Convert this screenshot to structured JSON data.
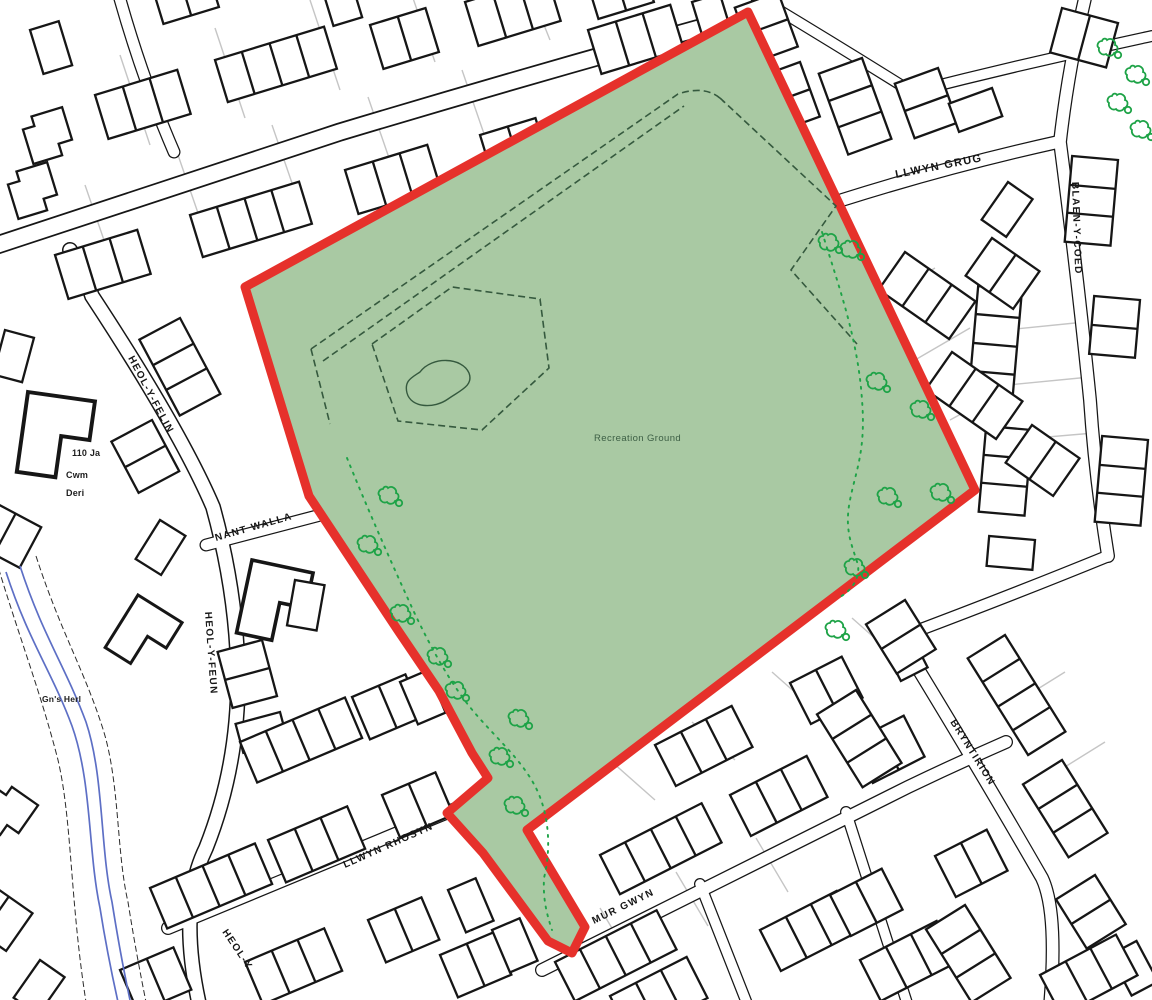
{
  "map": {
    "title": "Site location plan",
    "site_label": "Recreation Ground",
    "streets": {
      "llwyn_grug": "LLWYN GRUG",
      "blaen_y_coed": "BLAEN-Y-COED",
      "heol_y_felin": "HEOL-Y-FELIN",
      "nant_walla": "NANT WALLA",
      "heol_y_feun": "HEOL-Y-FEUN",
      "llwyn_rhosyn": "LLWYN RHOSYN",
      "mur_gwyn": "MUR GWYN",
      "bryntirion": "BRYNTIRION",
      "heol_y_partial": "HEOL-Y"
    },
    "places": {
      "cwm_deri_line1": "110 Ja",
      "cwm_deri_line2": "Cwm",
      "cwm_deri_line3": "Deri",
      "gns_herl": "Gn's Herl"
    }
  },
  "colors": {
    "boundary-red": "#e6312b",
    "site-green": "#a9c9a3",
    "tree-green": "#1ea347",
    "path-green": "#35593e",
    "label-green": "#3d5f45",
    "stream-blue": "#5d6fc5",
    "ink": "#161616",
    "parcel-gray": "#c5c5c5",
    "bg": "#ffffff"
  }
}
